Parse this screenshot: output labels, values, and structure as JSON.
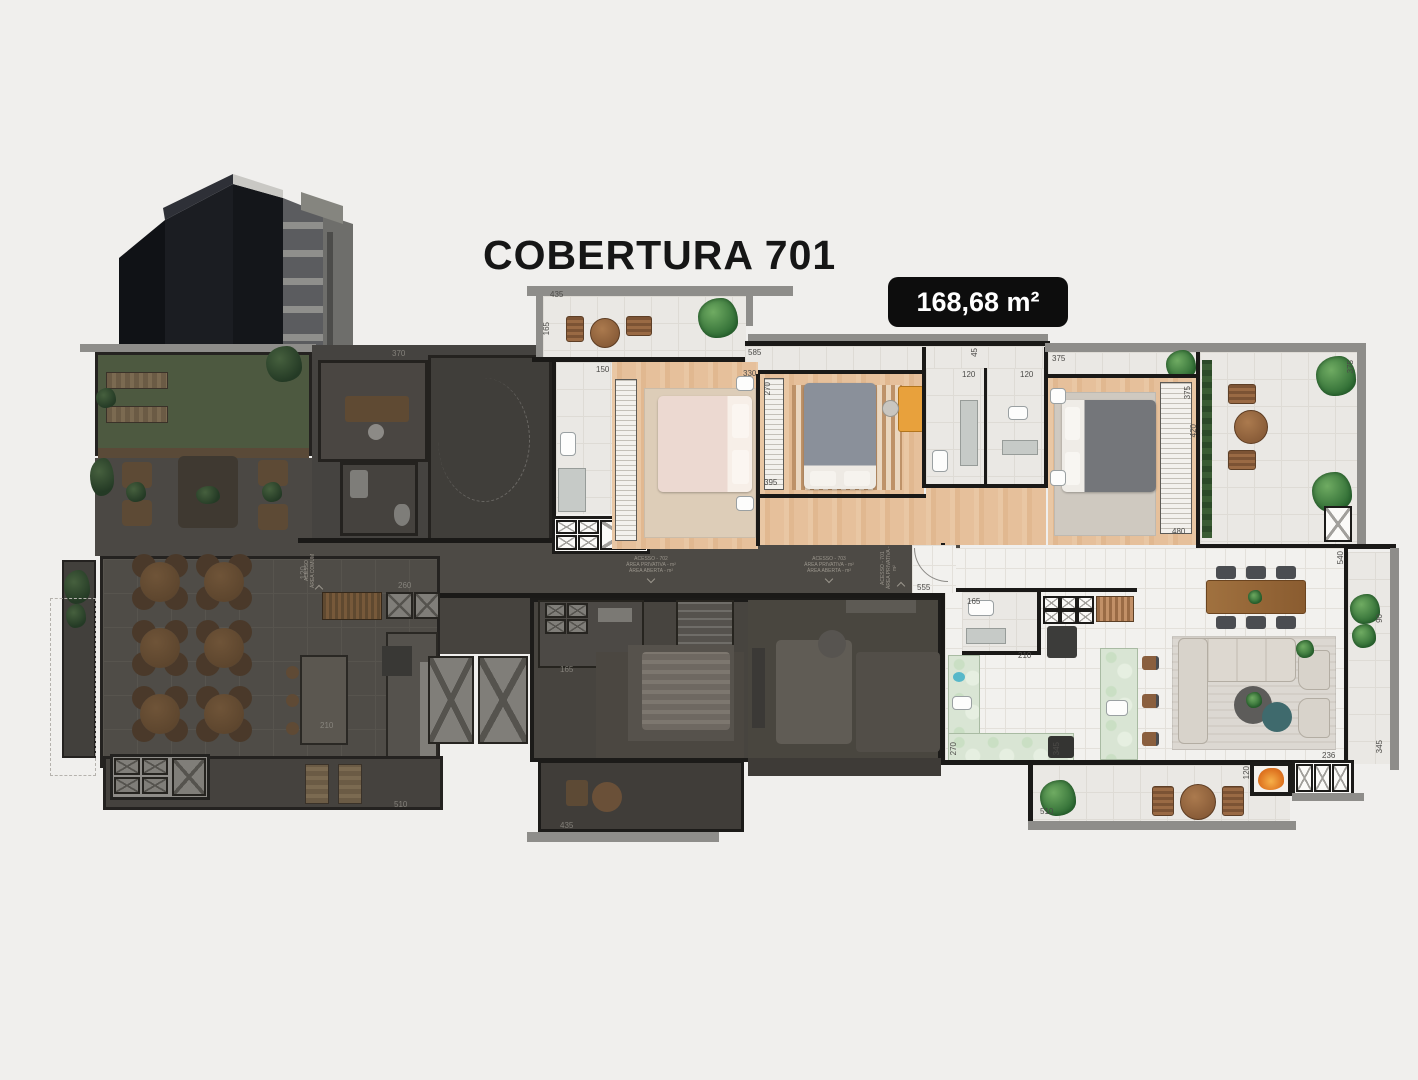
{
  "title": "COBERTURA 701",
  "badge": "168,68 m²",
  "colors": {
    "background": "#f0efed",
    "wall": "#1a1917",
    "parapet": "#8e8d8a",
    "wood_floor": "#e6c09b",
    "tile_floor": "#eae8e4",
    "kitchen_marble": "#d9e5d4",
    "dimmed_area": "#47443f",
    "badge_bg": "#0d0d0d",
    "badge_text": "#ffffff",
    "plant": "#2f6c34",
    "fire": "#e07722"
  },
  "labels": [
    {
      "t": "435",
      "x": 550,
      "y": 291
    },
    {
      "t": "165",
      "x": 543,
      "y": 322,
      "v": 1
    },
    {
      "t": "585",
      "x": 748,
      "y": 349
    },
    {
      "t": "45",
      "x": 971,
      "y": 348,
      "v": 1
    },
    {
      "t": "150",
      "x": 596,
      "y": 366
    },
    {
      "t": "330",
      "x": 743,
      "y": 370
    },
    {
      "t": "270",
      "x": 764,
      "y": 382,
      "v": 1
    },
    {
      "t": "395",
      "x": 764,
      "y": 479
    },
    {
      "t": "120",
      "x": 962,
      "y": 371
    },
    {
      "t": "120",
      "x": 1020,
      "y": 371
    },
    {
      "t": "375",
      "x": 1052,
      "y": 355
    },
    {
      "t": "375",
      "x": 1184,
      "y": 386,
      "v": 1
    },
    {
      "t": "420",
      "x": 1190,
      "y": 424,
      "v": 1
    },
    {
      "t": "480",
      "x": 1172,
      "y": 528
    },
    {
      "t": "375",
      "x": 1347,
      "y": 360,
      "v": 1
    },
    {
      "t": "540",
      "x": 1337,
      "y": 551,
      "v": 1
    },
    {
      "t": "90",
      "x": 1376,
      "y": 614,
      "v": 1
    },
    {
      "t": "345",
      "x": 1376,
      "y": 740,
      "v": 1
    },
    {
      "t": "555",
      "x": 917,
      "y": 584
    },
    {
      "t": "165",
      "x": 967,
      "y": 598
    },
    {
      "t": "210",
      "x": 1018,
      "y": 652
    },
    {
      "t": "270",
      "x": 950,
      "y": 742,
      "v": 1
    },
    {
      "t": "345",
      "x": 1053,
      "y": 742,
      "v": 1
    },
    {
      "t": "510",
      "x": 1040,
      "y": 808
    },
    {
      "t": "120",
      "x": 1243,
      "y": 766,
      "v": 1
    },
    {
      "t": "236",
      "x": 1322,
      "y": 752
    },
    {
      "t": "370",
      "x": 392,
      "y": 350,
      "d": 1
    },
    {
      "t": "120",
      "x": 300,
      "y": 566,
      "v": 1,
      "d": 1
    },
    {
      "t": "260",
      "x": 398,
      "y": 582,
      "d": 1
    },
    {
      "t": "165",
      "x": 560,
      "y": 666,
      "d": 1
    },
    {
      "t": "210",
      "x": 320,
      "y": 722,
      "d": 1
    },
    {
      "t": "510",
      "x": 394,
      "y": 801,
      "d": 1
    },
    {
      "t": "435",
      "x": 560,
      "y": 822,
      "d": 1
    }
  ],
  "access_blocks": [
    {
      "x": 304,
      "y": 548,
      "vertical": true,
      "lines": [
        "ACESSO",
        "ÁREA COMUM"
      ]
    },
    {
      "x": 596,
      "y": 556,
      "vertical": false,
      "lines": [
        "ACESSO - 702",
        "ÁREA PRIVATIVA - m²",
        "ÁREA ABERTA - m²"
      ]
    },
    {
      "x": 774,
      "y": 556,
      "vertical": false,
      "lines": [
        "ACESSO - 703",
        "ÁREA PRIVATIVA - m²",
        "ÁREA ABERTA - m²"
      ]
    },
    {
      "x": 880,
      "y": 545,
      "vertical": true,
      "lines": [
        "ACESSO - 701",
        "ÁREA PRIVATIVA - m²"
      ]
    }
  ]
}
